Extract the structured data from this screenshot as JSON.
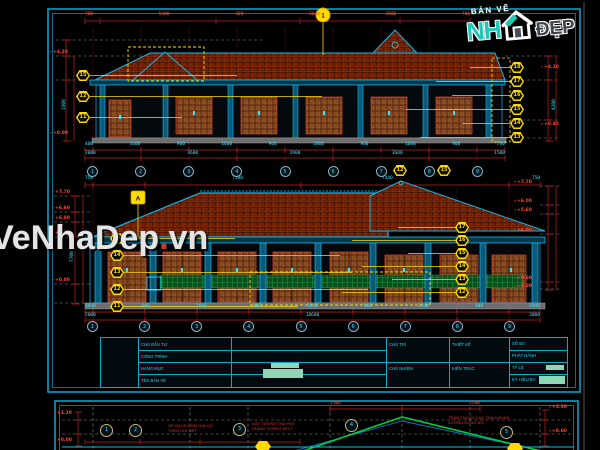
{
  "watermark": {
    "part1": "VeNhaDep",
    "dot": ".",
    "part2": "vn"
  },
  "logo": {
    "tagline": "BẢN VẼ",
    "name_left": "NH",
    "name_right": "ĐẸP"
  },
  "d1": {
    "top_dims": [
      "700",
      "5400",
      "300",
      "3600",
      "3600",
      "700"
    ],
    "section_callout": "1",
    "left_tags": [
      "15",
      "12",
      "11"
    ],
    "right_tags": [
      "18",
      "17",
      "16",
      "15",
      "14",
      "13"
    ],
    "extra_tags": [
      "12",
      "15"
    ],
    "levels_left": {
      "top": "+4.20",
      "bottom": "+0.00"
    },
    "levels_right": {
      "top": "+4.20",
      "bottom": "+0.45"
    },
    "vdim_left": "3300",
    "vdim_right": "4200",
    "dims_row1": [
      "400",
      "1600",
      "900",
      "1600",
      "900",
      "1800",
      "900",
      "1600",
      "900",
      "750"
    ],
    "dims_row2": [
      "2000",
      "3600",
      "3900",
      "3600",
      "1500"
    ],
    "grid": [
      "1",
      "2",
      "3",
      "4",
      "5",
      "6",
      "7",
      "8",
      "9"
    ]
  },
  "d2": {
    "top_dims": [
      "750",
      "7500",
      "7440",
      "750"
    ],
    "detail_callout": "A",
    "left_tags": [
      "15",
      "14",
      "13",
      "12",
      "11"
    ],
    "right_tags": [
      "17",
      "16",
      "15",
      "14",
      "13",
      "12"
    ],
    "levels_left": [
      "+7.70",
      "+6.60",
      "+6.00",
      "+4.20",
      "+0.00"
    ],
    "levels_right": [
      "+7.70",
      "+6.00",
      "+5.60",
      "+4.00",
      "+0.60",
      "+0.00"
    ],
    "vdim_left": "7700",
    "dims_row1": [
      "1940",
      "900",
      "1940",
      "900",
      "1940",
      "900",
      "1940",
      "900",
      "1940"
    ],
    "dims_row2": [
      "2000",
      "18680",
      "2000"
    ],
    "grid": [
      "1",
      "2",
      "3",
      "4",
      "5",
      "6",
      "7",
      "8",
      "9"
    ]
  },
  "titleblock": {
    "left_rows": [
      "CHỦ ĐẦU TƯ",
      "CÔNG TRÌNH",
      "HẠNG MỤC",
      "TÊN BẢN VẼ"
    ],
    "mid_cells": [
      "CHỦ TRÌ",
      "THIẾT KẾ",
      "CHỦ NHIỆM",
      "KIẾN TRÚC"
    ],
    "right_rows": [
      "SỐ BV",
      "PHÁT HÀNH",
      "TỶ LỆ",
      "KÝ HIỆU BV"
    ]
  },
  "sheet2": {
    "top_dims": [
      "1500",
      "2500"
    ],
    "levels_left": [
      "+1.20",
      "+0.00"
    ],
    "levels_right": [
      "+3.30",
      "+0.60"
    ],
    "callouts": [
      "1",
      "2",
      "3",
      "4",
      "5"
    ],
    "ann_left": "ỐP GẠCH GỐM GIẢ CỔ\nTHEO CHI TIẾT",
    "ann_mid": "XÂY TƯỜNG THU HỒI\nGIẰNG TƯỜNG BTCT",
    "ann_right": "TRẦN THẠCH CAO TẤM KHUNG\nXƯƠNG ĐỒNG BỘ"
  },
  "colors": {
    "sheet_border": "#0a9fc9",
    "dim_red": "#cc2020",
    "dim_text": "#2de6ff",
    "callout_yellow": "#ffd900",
    "roof_tile": "#7c2605",
    "wood": "#8a4a22",
    "rail_green": "#0b4d1d",
    "logo_teal": "#1fc9b8"
  }
}
